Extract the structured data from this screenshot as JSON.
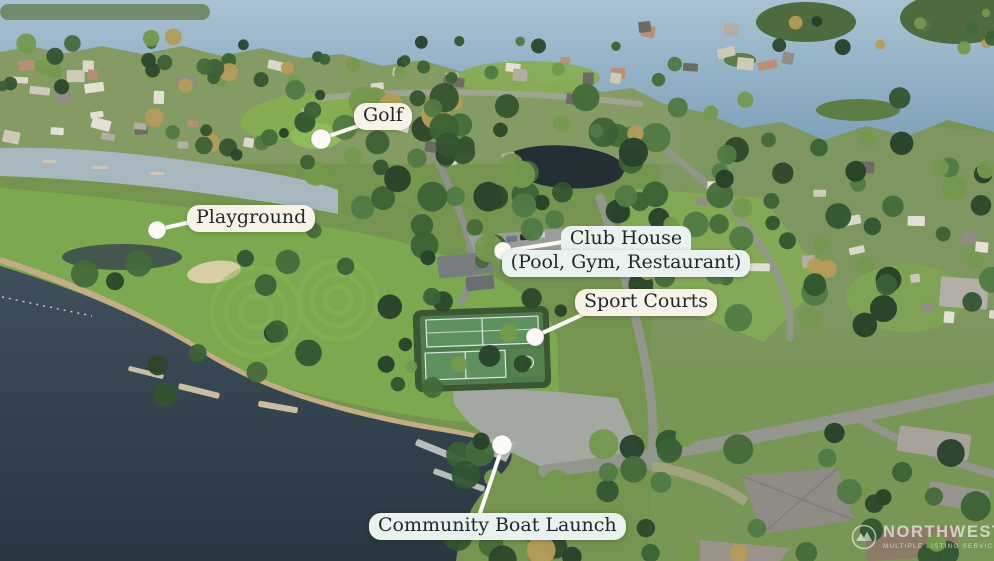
{
  "callouts": {
    "golf": {
      "label": "Golf"
    },
    "playground": {
      "label": "Playground"
    },
    "club_house": {
      "line1": "Club House",
      "line2": "(Pool, Gym, Restaurant)"
    },
    "sport_courts": {
      "label": "Sport Courts"
    },
    "boat_launch": {
      "label": "Community Boat Launch"
    }
  },
  "watermark": {
    "brand": "NORTHWEST",
    "subtitle": "MULTIPLE LISTING SERVICE"
  },
  "colors": {
    "label_bg_cream": "#f7f3e8",
    "label_bg_mint": "#e9f2ee",
    "label_text": "#23272c",
    "connector": "#fbfaf4",
    "water_top": "#8fadc2",
    "water_channel": "#a6b8bd",
    "lake_dark": "#34464f",
    "park_green": "#7ca84f",
    "court_green": "#5f9160"
  }
}
